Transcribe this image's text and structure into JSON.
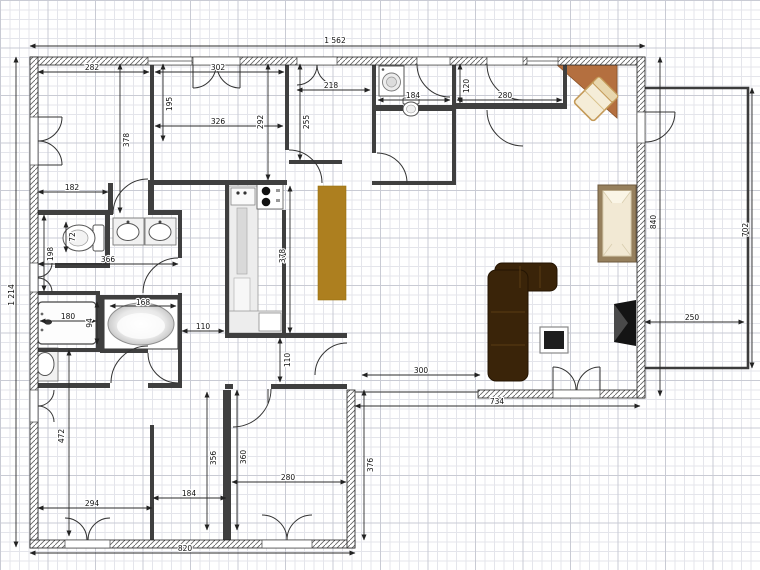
{
  "plan": {
    "dimensions": {
      "total_width": "1 562",
      "total_height": "1 214",
      "wing_bottom_width": "820",
      "living_bottom_width": "734",
      "living_opening_width": "300",
      "wing_right_height": "376",
      "right_wall_height": "840",
      "terrace_height": "702",
      "terrace_width": "250",
      "bedroom1_width": "282",
      "bedroom1_height": "378",
      "hall_top_width": "302",
      "hall_left_height": "195",
      "hall_width": "326",
      "hall_right_height": "292",
      "room3_height": "255",
      "room3_width": "218",
      "bath2_width": "184",
      "closet_height": "120",
      "closet_width": "280",
      "vestibule_width": "182",
      "wc_height": "198",
      "wc_width": "72",
      "bath1_width": "366",
      "shower_width": "180",
      "shower_height": "94",
      "bathtub_width": "168",
      "hallway_width": "110",
      "corridor_height": "110",
      "kitchen_height": "378",
      "bedroom2_height": "472",
      "bedroom2_width": "294",
      "room_bm_width": "184",
      "room_bm_height": "356",
      "room_br_height": "360",
      "room_br_width": "280"
    },
    "colors": {
      "sofa": "#3a2409",
      "table_island": "#ad7f1f",
      "desk": "#b46f3f",
      "bed_frame": "#96805d",
      "tv": "#141414"
    },
    "furniture": [
      "sofa",
      "bed",
      "corner-desk",
      "desk-chair",
      "tv",
      "coffee-table",
      "dining-island",
      "kitchen-counter",
      "stove",
      "kitchen-sink",
      "bathtub",
      "shower-tray",
      "double-washbasin",
      "washbasin",
      "toilet",
      "wall-toilet",
      "washing-machine"
    ]
  }
}
